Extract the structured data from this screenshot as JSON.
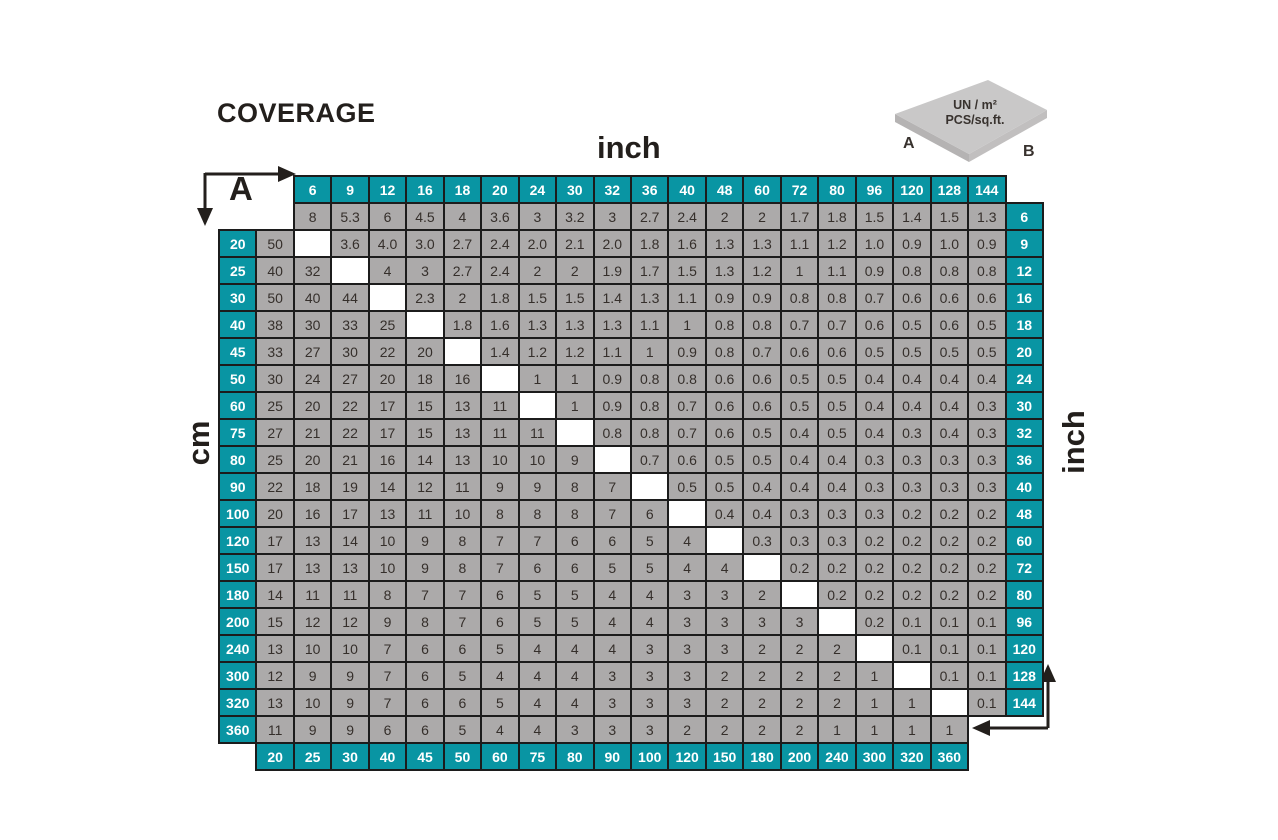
{
  "title": "COVERAGE",
  "axis_labels": {
    "top": "inch",
    "bottom": "cm",
    "left": "cm",
    "right": "inch"
  },
  "zone_labels": {
    "a": "A",
    "b": "B"
  },
  "tile_legend": {
    "line1": "UN / m²",
    "line2": "PCS/sq.ft.",
    "label_a": "A",
    "label_b": "B"
  },
  "colors": {
    "teal": "#0995a3",
    "cell_gray": "#acaaaa",
    "border": "#1c1c1c",
    "text_dark": "#352f2b",
    "tile_top": "#c9c8c8",
    "tile_side_left": "#b5b3b3",
    "tile_side_right": "#c1bfbf"
  },
  "chart_data": {
    "type": "table",
    "title": "COVERAGE",
    "description_visible": "Tile coverage matrix: upper-right triangle UN / m², lower-left triangle PCS/sq.ft., blank white diagonal where A equals B",
    "col_headers_inch": [
      "6",
      "9",
      "12",
      "16",
      "18",
      "20",
      "24",
      "30",
      "32",
      "36",
      "40",
      "48",
      "60",
      "72",
      "80",
      "96",
      "120",
      "128",
      "144"
    ],
    "bottom_headers_cm": [
      "20",
      "25",
      "30",
      "40",
      "45",
      "50",
      "60",
      "75",
      "80",
      "90",
      "100",
      "120",
      "150",
      "180",
      "200",
      "240",
      "300",
      "320",
      "360"
    ],
    "rows": [
      {
        "left": null,
        "right": "6",
        "cells": [
          null,
          "8",
          "5.3",
          "6",
          "4.5",
          "4",
          "3.6",
          "3",
          "3.2",
          "3",
          "2.7",
          "2.4",
          "2",
          "2",
          "1.7",
          "1.8",
          "1.5",
          "1.4",
          "1.5",
          "1.3"
        ]
      },
      {
        "left": "20",
        "right": "9",
        "cells": [
          "50",
          "",
          "3.6",
          "4.0",
          "3.0",
          "2.7",
          "2.4",
          "2.0",
          "2.1",
          "2.0",
          "1.8",
          "1.6",
          "1.3",
          "1.3",
          "1.1",
          "1.2",
          "1.0",
          "0.9",
          "1.0",
          "0.9"
        ]
      },
      {
        "left": "25",
        "right": "12",
        "cells": [
          "40",
          "32",
          "",
          "4",
          "3",
          "2.7",
          "2.4",
          "2",
          "2",
          "1.9",
          "1.7",
          "1.5",
          "1.3",
          "1.2",
          "1",
          "1.1",
          "0.9",
          "0.8",
          "0.8",
          "0.8"
        ]
      },
      {
        "left": "30",
        "right": "16",
        "cells": [
          "50",
          "40",
          "44",
          "",
          "2.3",
          "2",
          "1.8",
          "1.5",
          "1.5",
          "1.4",
          "1.3",
          "1.1",
          "0.9",
          "0.9",
          "0.8",
          "0.8",
          "0.7",
          "0.6",
          "0.6",
          "0.6"
        ]
      },
      {
        "left": "40",
        "right": "18",
        "cells": [
          "38",
          "30",
          "33",
          "25",
          "",
          "1.8",
          "1.6",
          "1.3",
          "1.3",
          "1.3",
          "1.1",
          "1",
          "0.8",
          "0.8",
          "0.7",
          "0.7",
          "0.6",
          "0.5",
          "0.6",
          "0.5"
        ]
      },
      {
        "left": "45",
        "right": "20",
        "cells": [
          "33",
          "27",
          "30",
          "22",
          "20",
          "",
          "1.4",
          "1.2",
          "1.2",
          "1.1",
          "1",
          "0.9",
          "0.8",
          "0.7",
          "0.6",
          "0.6",
          "0.5",
          "0.5",
          "0.5",
          "0.5"
        ]
      },
      {
        "left": "50",
        "right": "24",
        "cells": [
          "30",
          "24",
          "27",
          "20",
          "18",
          "16",
          "",
          "1",
          "1",
          "0.9",
          "0.8",
          "0.8",
          "0.6",
          "0.6",
          "0.5",
          "0.5",
          "0.4",
          "0.4",
          "0.4",
          "0.4"
        ]
      },
      {
        "left": "60",
        "right": "30",
        "cells": [
          "25",
          "20",
          "22",
          "17",
          "15",
          "13",
          "11",
          "",
          "1",
          "0.9",
          "0.8",
          "0.7",
          "0.6",
          "0.6",
          "0.5",
          "0.5",
          "0.4",
          "0.4",
          "0.4",
          "0.3"
        ]
      },
      {
        "left": "75",
        "right": "32",
        "cells": [
          "27",
          "21",
          "22",
          "17",
          "15",
          "13",
          "11",
          "11",
          "",
          "0.8",
          "0.8",
          "0.7",
          "0.6",
          "0.5",
          "0.4",
          "0.5",
          "0.4",
          "0.3",
          "0.4",
          "0.3"
        ]
      },
      {
        "left": "80",
        "right": "36",
        "cells": [
          "25",
          "20",
          "21",
          "16",
          "14",
          "13",
          "10",
          "10",
          "9",
          "",
          "0.7",
          "0.6",
          "0.5",
          "0.5",
          "0.4",
          "0.4",
          "0.3",
          "0.3",
          "0.3",
          "0.3"
        ]
      },
      {
        "left": "90",
        "right": "40",
        "cells": [
          "22",
          "18",
          "19",
          "14",
          "12",
          "11",
          "9",
          "9",
          "8",
          "7",
          "",
          "0.5",
          "0.5",
          "0.4",
          "0.4",
          "0.4",
          "0.3",
          "0.3",
          "0.3",
          "0.3"
        ]
      },
      {
        "left": "100",
        "right": "48",
        "cells": [
          "20",
          "16",
          "17",
          "13",
          "11",
          "10",
          "8",
          "8",
          "8",
          "7",
          "6",
          "",
          "0.4",
          "0.4",
          "0.3",
          "0.3",
          "0.3",
          "0.2",
          "0.2",
          "0.2"
        ]
      },
      {
        "left": "120",
        "right": "60",
        "cells": [
          "17",
          "13",
          "14",
          "10",
          "9",
          "8",
          "7",
          "7",
          "6",
          "6",
          "5",
          "4",
          "",
          "0.3",
          "0.3",
          "0.3",
          "0.2",
          "0.2",
          "0.2",
          "0.2"
        ]
      },
      {
        "left": "150",
        "right": "72",
        "cells": [
          "17",
          "13",
          "13",
          "10",
          "9",
          "8",
          "7",
          "6",
          "6",
          "5",
          "5",
          "4",
          "4",
          "",
          "0.2",
          "0.2",
          "0.2",
          "0.2",
          "0.2",
          "0.2"
        ]
      },
      {
        "left": "180",
        "right": "80",
        "cells": [
          "14",
          "11",
          "11",
          "8",
          "7",
          "7",
          "6",
          "5",
          "5",
          "4",
          "4",
          "3",
          "3",
          "2",
          "",
          "0.2",
          "0.2",
          "0.2",
          "0.2",
          "0.2"
        ]
      },
      {
        "left": "200",
        "right": "96",
        "cells": [
          "15",
          "12",
          "12",
          "9",
          "8",
          "7",
          "6",
          "5",
          "5",
          "4",
          "4",
          "3",
          "3",
          "3",
          "3",
          "",
          "0.2",
          "0.1",
          "0.1",
          "0.1"
        ]
      },
      {
        "left": "240",
        "right": "120",
        "cells": [
          "13",
          "10",
          "10",
          "7",
          "6",
          "6",
          "5",
          "4",
          "4",
          "4",
          "3",
          "3",
          "3",
          "2",
          "2",
          "2",
          "",
          "0.1",
          "0.1",
          "0.1"
        ]
      },
      {
        "left": "300",
        "right": "128",
        "cells": [
          "12",
          "9",
          "9",
          "7",
          "6",
          "5",
          "4",
          "4",
          "4",
          "3",
          "3",
          "3",
          "2",
          "2",
          "2",
          "2",
          "1",
          "",
          "0.1",
          "0.1"
        ]
      },
      {
        "left": "320",
        "right": "144",
        "cells": [
          "13",
          "10",
          "9",
          "7",
          "6",
          "6",
          "5",
          "4",
          "4",
          "3",
          "3",
          "3",
          "2",
          "2",
          "2",
          "2",
          "1",
          "1",
          "",
          "0.1"
        ]
      },
      {
        "left": "360",
        "right": null,
        "cells": [
          "11",
          "9",
          "9",
          "6",
          "6",
          "5",
          "4",
          "4",
          "3",
          "3",
          "3",
          "2",
          "2",
          "2",
          "2",
          "1",
          "1",
          "1",
          "1",
          null
        ]
      }
    ]
  }
}
